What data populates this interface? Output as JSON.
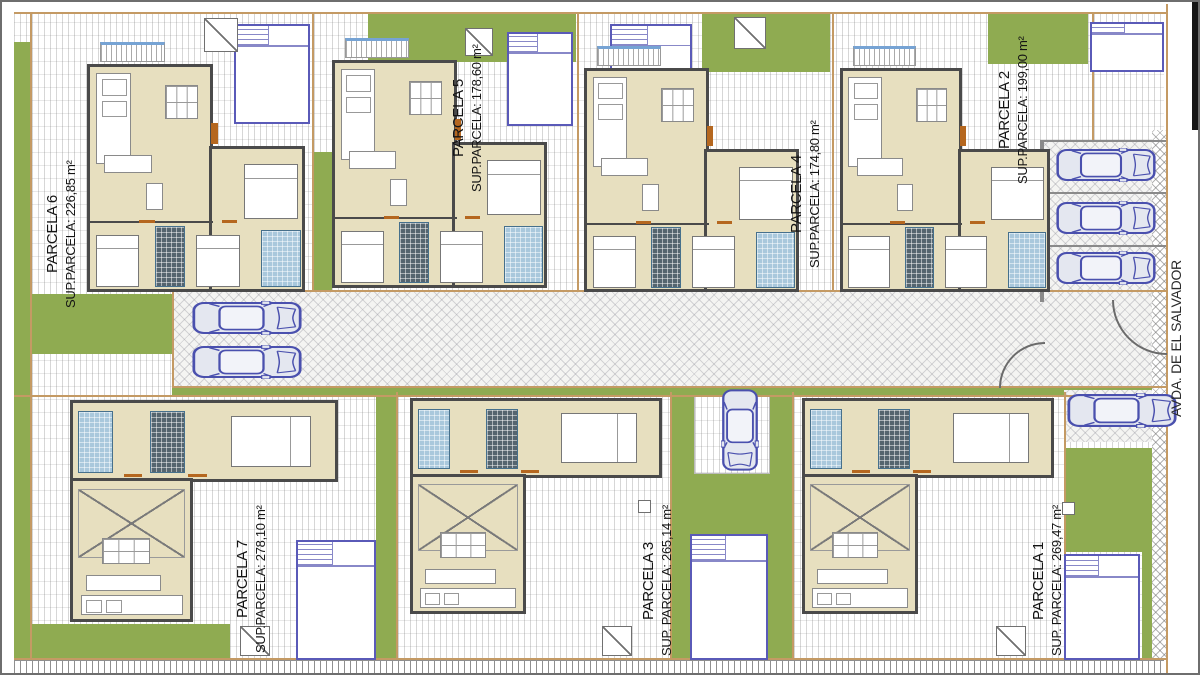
{
  "street": {
    "label": "AVDA. DE EL SALVADOR"
  },
  "parcels": {
    "p6": {
      "name": "PARCELA 6",
      "area": "SUP.PARCELA: 226,85 m²"
    },
    "p5": {
      "name": "PARCELA 5",
      "area": "SUP.PARCELA: 178,60 m²"
    },
    "p4": {
      "name": "PARCELA 4",
      "area": "SUP.PARCELA: 174,80 m²"
    },
    "p2": {
      "name": "PARCELA 2",
      "area": "SUP.PARCELA: 199,00 m²"
    },
    "p7": {
      "name": "PARCELA 7",
      "area": "SUP.PARCELA: 278,10 m²"
    },
    "p3": {
      "name": "PARCELA 3",
      "area": "SUP. PARCELA: 265,14 m²"
    },
    "p1": {
      "name": "PARCELA 1",
      "area": "SUP. PARCELA: 269,47 m²"
    }
  },
  "icons": {
    "car": "car-icon",
    "roof_vent": "roof-vent-icon",
    "pool": "swimming-pool",
    "stairs": "stairs-icon"
  },
  "colors": {
    "garden": "#8fab51",
    "boundary": "#c49a64",
    "car_outline": "#4a50ae",
    "pool_border": "#5a5ab8",
    "wall": "#4a4a4a",
    "floor": "#e7dfbf",
    "bath_tile": "#a9c8dc"
  }
}
